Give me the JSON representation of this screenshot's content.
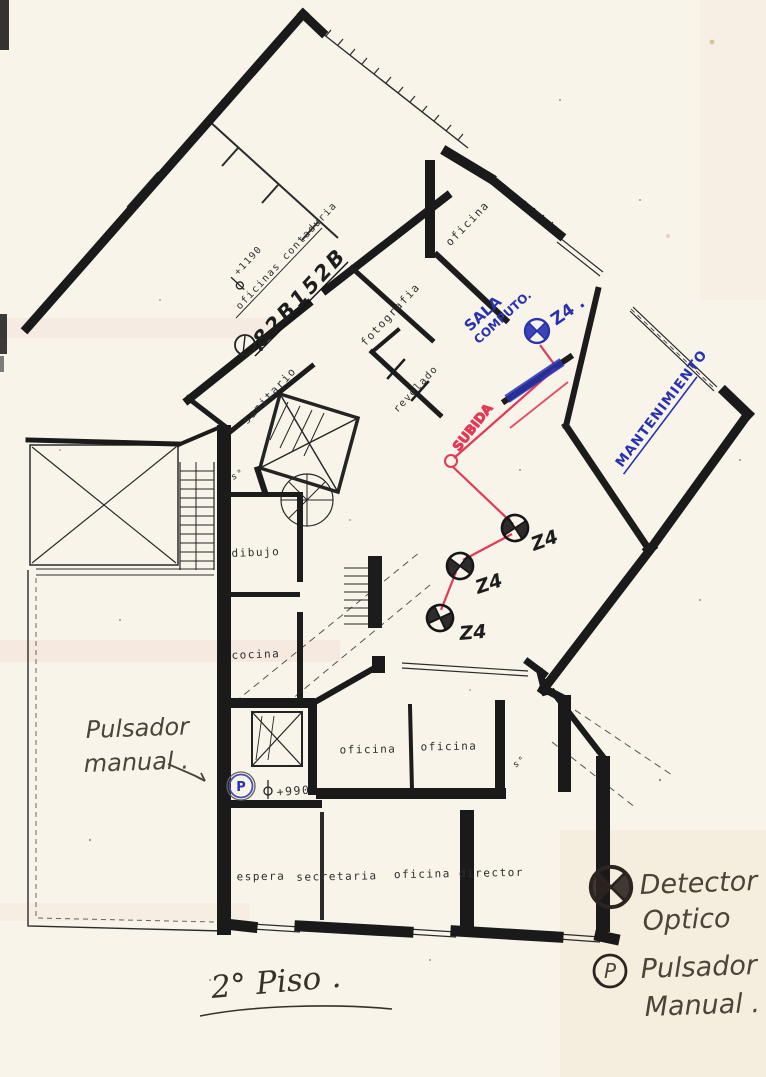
{
  "page": {
    "title_text": "2° Piso ."
  },
  "plan": {
    "stamp": "82B152B",
    "elevation_upper": "+1190",
    "elevation_lower": "+990",
    "rooms": {
      "oficinas_contaduria": "oficinas contaduria",
      "oficina_top": "oficina",
      "fotografia": "fotografia",
      "revelado": "revelado",
      "sanitario": "sanitario",
      "dibujo": "dibujo",
      "cocina": "cocina",
      "oficina_left": "oficina",
      "oficina_right": "oficina",
      "espera": "espera",
      "secretaria": "secretaria",
      "oficina_director": "oficina director",
      "service_upper": "s°",
      "service_lower": "s°"
    }
  },
  "annotations": {
    "sala_computo_line1": "SALA",
    "sala_computo_line2": "COMPUTO.",
    "zone_blue": "Z4 .",
    "mantenimiento": "MANTENIMIENTO",
    "subida": "SUBIDA",
    "zone_1": "Z4",
    "zone_2": "Z4",
    "zone_3": "Z4",
    "pulsador_note_line1": "Pulsador",
    "pulsador_note_line2": "manual .",
    "plan_pushbutton": "P"
  },
  "legend": {
    "detector_line1": "Detector",
    "detector_line2": "Optico",
    "pulsador_line1": "Pulsador",
    "pulsador_line2": "Manual .",
    "p_symbol": "P"
  },
  "colors": {
    "paper": "#f8f4ea",
    "wall": "#1a1a1a",
    "ink_blue": "#2832b0",
    "ink_red": "#e23a55",
    "pencil": "#4c4339"
  }
}
